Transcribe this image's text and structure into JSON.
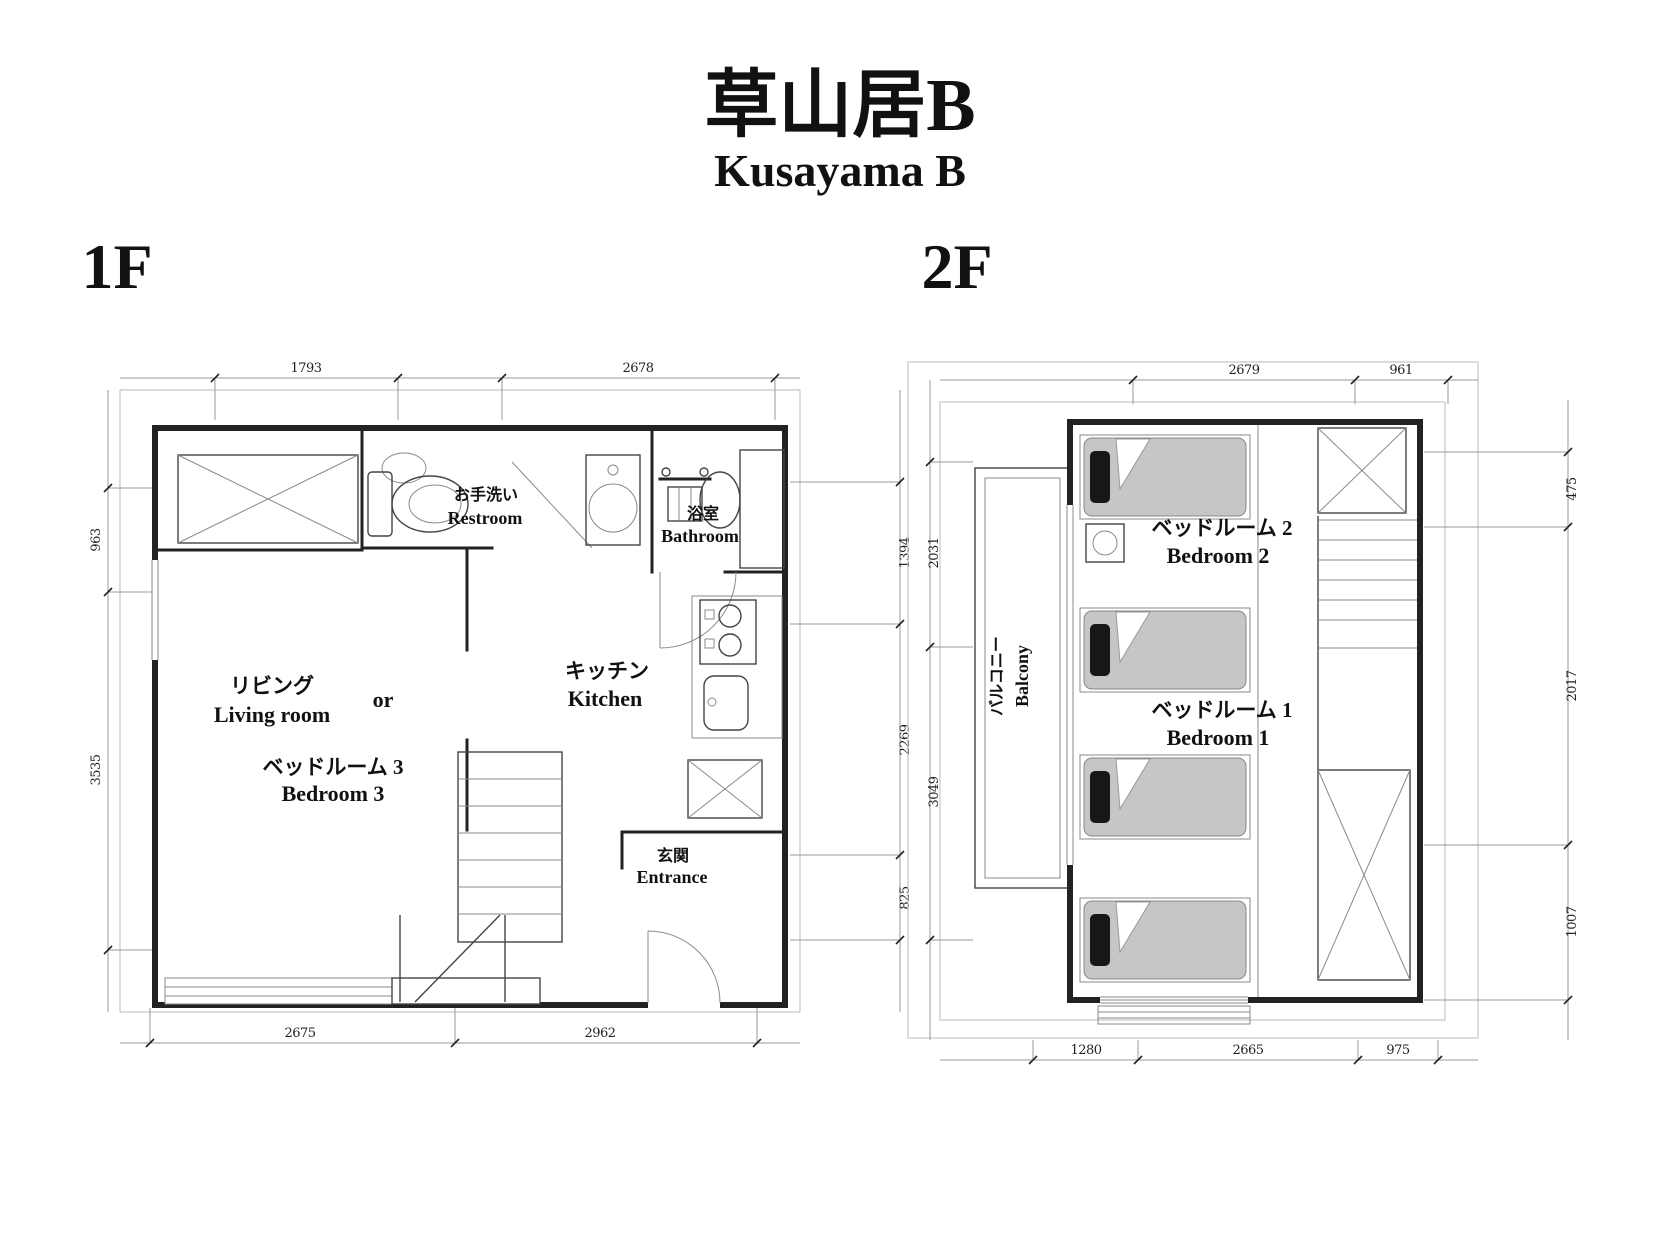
{
  "title": {
    "jp": "草山居B",
    "en": "Kusayama B"
  },
  "floor1": {
    "label": "1F",
    "living_jp": "リビング",
    "living_en": "Living room",
    "or": "or",
    "bedroom3_jp": "ベッドルーム 3",
    "bedroom3_en": "Bedroom 3",
    "kitchen_jp": "キッチン",
    "kitchen_en": "Kitchen",
    "restroom_jp": "お手洗い",
    "restroom_en": "Restroom",
    "bathroom_jp": "浴室",
    "bathroom_en": "Bathroom",
    "entrance_jp": "玄関",
    "entrance_en": "Entrance",
    "dim_top": [
      "1793",
      "2678"
    ],
    "dim_left": [
      "963",
      "3535"
    ],
    "dim_right": [
      "1394",
      "2269",
      "825"
    ],
    "dim_bottom": [
      "2675",
      "2962"
    ]
  },
  "floor2": {
    "label": "2F",
    "bedroom2_jp": "ベッドルーム 2",
    "bedroom2_en": "Bedroom 2",
    "bedroom1_jp": "ベッドルーム 1",
    "bedroom1_en": "Bedroom 1",
    "balcony_jp": "バルコニー",
    "balcony_en": "Balcony",
    "dim_top": [
      "2679",
      "961"
    ],
    "dim_left": [
      "2031",
      "3049"
    ],
    "dim_right": [
      "475",
      "2017",
      "1007"
    ],
    "dim_bottom": [
      "1280",
      "2665",
      "975"
    ]
  },
  "colors": {
    "wall": "#222222",
    "dim_line": "#9a9a9a",
    "mattress": "#c6c6c6",
    "pillow": "#171717"
  }
}
